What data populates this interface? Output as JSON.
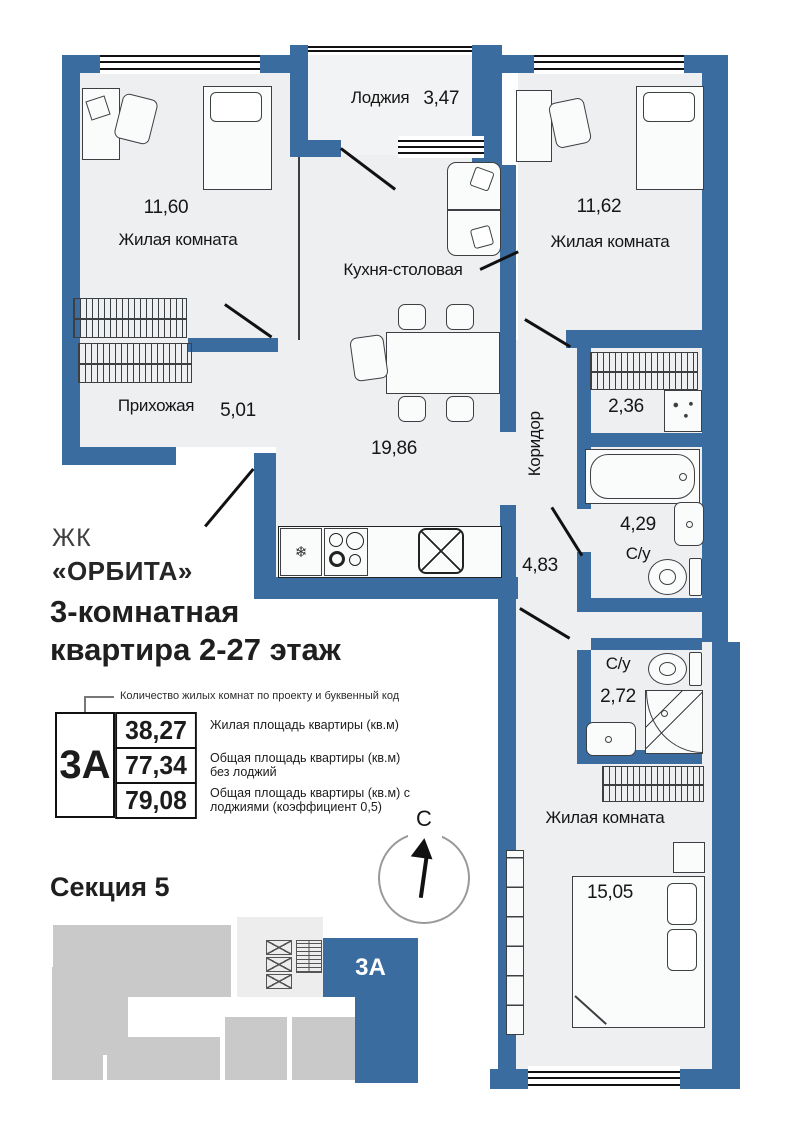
{
  "plan": {
    "rooms": [
      {
        "id": "loggia",
        "label": "Лоджия",
        "area": "3,47"
      },
      {
        "id": "living-room-1",
        "label": "Жилая комната",
        "area": "11,60"
      },
      {
        "id": "living-room-2",
        "label": "Жилая комната",
        "area": "11,62"
      },
      {
        "id": "kitchen-dining",
        "label": "Кухня-столовая",
        "area": "19,86"
      },
      {
        "id": "hallway",
        "label": "Прихожая",
        "area": "5,01"
      },
      {
        "id": "corridor",
        "label": "Коридор",
        "area": "4,83"
      },
      {
        "id": "storage",
        "label": "",
        "area": "2,36"
      },
      {
        "id": "bathroom-1",
        "label": "С/у",
        "area": "4,29"
      },
      {
        "id": "bathroom-2",
        "label": "С/у",
        "area": "2,72"
      },
      {
        "id": "living-room-3",
        "label": "Жилая комната",
        "area": "15,05"
      }
    ],
    "fridge_glyph": "❄"
  },
  "info": {
    "complex_prefix": "ЖК",
    "complex_name": "«ОРБИТА»",
    "title_line1": "3-комнатная",
    "title_line2": "квартира 2-27 этаж",
    "callout": "Количество жилых комнат по проекту и буквенный код",
    "unit_code": "3А",
    "area_rows": [
      {
        "value": "38,27",
        "desc": "Жилая площадь квартиры (кв.м)"
      },
      {
        "value": "77,34",
        "desc": "Общая площадь квартиры (кв.м) без лоджий"
      },
      {
        "value": "79,08",
        "desc": "Общая площадь квартиры (кв.м) с лоджиями (коэффициент 0,5)"
      }
    ]
  },
  "section": {
    "title": "Секция 5",
    "compass_label": "С",
    "unit_code": "3А"
  },
  "colors": {
    "wall_blue": "#3b6ca0",
    "room_fill": "#edeff0",
    "block_gray": "#c9c9c9",
    "core_gray": "#ededed",
    "line_dark": "#1f1f1f"
  }
}
